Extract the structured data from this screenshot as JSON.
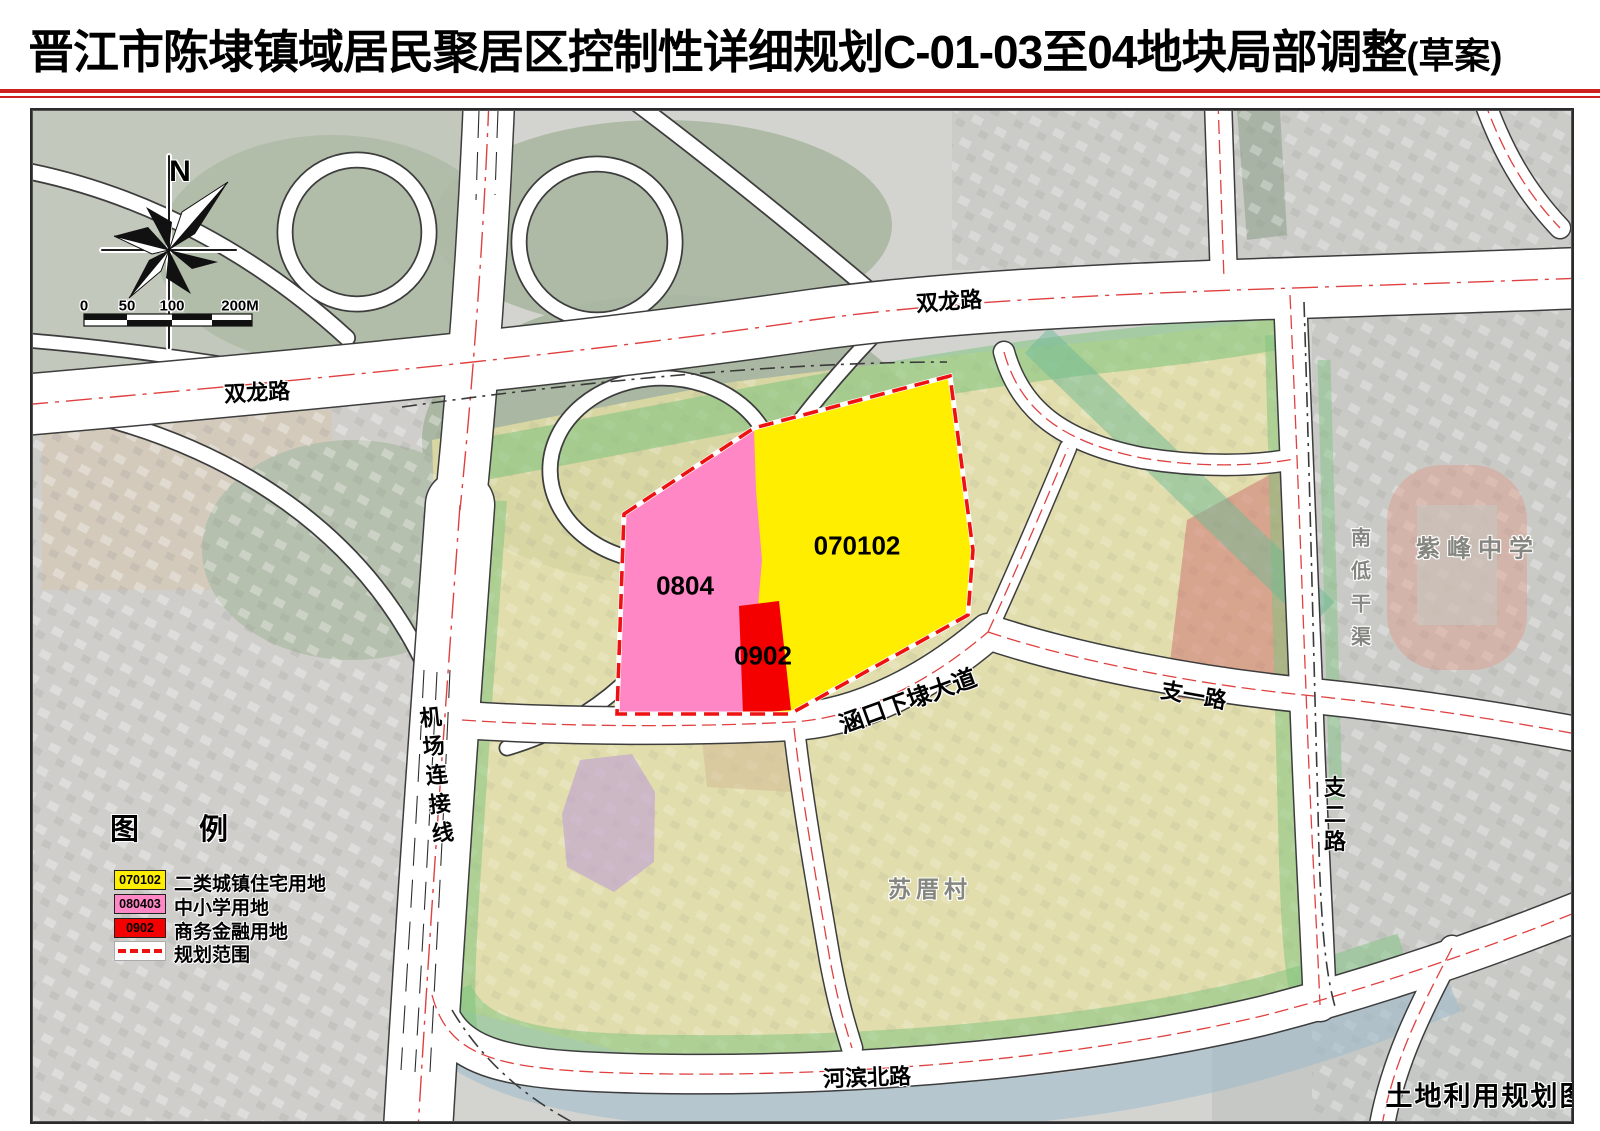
{
  "title": {
    "main": "晋江市陈埭镇域居民聚居区控制性详细规划C-01-03至04地块局部调整",
    "suffix": "(草案)"
  },
  "compass": {
    "north": "N"
  },
  "scalebar": {
    "ticks": [
      "0",
      "50",
      "100",
      "200M"
    ]
  },
  "zones": [
    {
      "code": "0804",
      "color": "#ff87c5"
    },
    {
      "code": "070102",
      "color": "#ffee00"
    },
    {
      "code": "0902",
      "color": "#f50000"
    }
  ],
  "roads": {
    "shuanglong": "双龙路",
    "jichang": "机场连接线",
    "hankou": "涵口下埭大道",
    "zhiyi": "支一路",
    "zhier": "支二路",
    "hebin": "河滨北路"
  },
  "places": {
    "school": "紫峰中学",
    "canal": "南低干渠",
    "village": "苏厝村"
  },
  "legend": {
    "title": "图 例",
    "items": [
      {
        "code": "070102",
        "color": "#ffee00",
        "label": "二类城镇住宅用地"
      },
      {
        "code": "080403",
        "color": "#ff87c5",
        "label": "中小学用地"
      },
      {
        "code": "0902",
        "color": "#f50000",
        "label": "商务金融用地"
      },
      {
        "code": "",
        "color": "#ee1111",
        "label": "规划范围",
        "type": "boundary-dashed"
      }
    ]
  },
  "corner_label": "土地利用规划图",
  "colors": {
    "title_rule": "#cf2020",
    "boundary": "#ee1111",
    "green_belt": "#7dc37d",
    "village_tint": "#e6dfa2",
    "water": "#9cb9cc"
  }
}
